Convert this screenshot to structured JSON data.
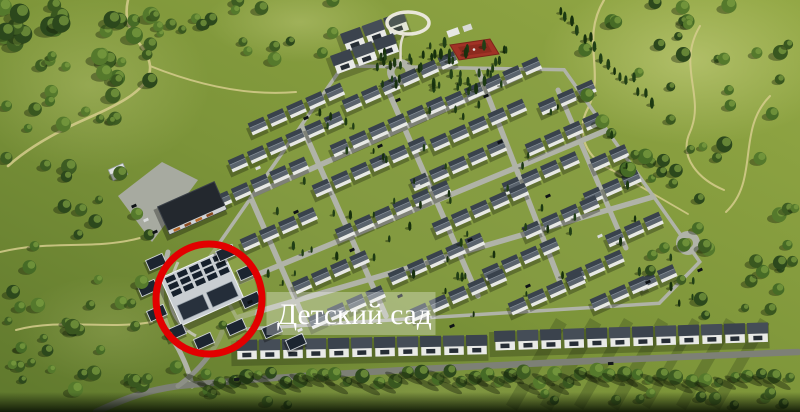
{
  "scene": {
    "description": "Aerial 3D render of a cottage village master plan surrounded by green hills and woodland",
    "colors": {
      "lawn": "#7f9840",
      "forest": "#2e4a1c",
      "road": "#b0b3a8",
      "roof": "#454d57",
      "sports_court": "#a13226",
      "dirt_path": "#d6cd8d"
    }
  },
  "annotation": {
    "label": "Детский сад",
    "circle_color": "#e20000",
    "label_bg": "rgba(255,255,255,0.30)",
    "label_text_color": "#ffffff"
  }
}
